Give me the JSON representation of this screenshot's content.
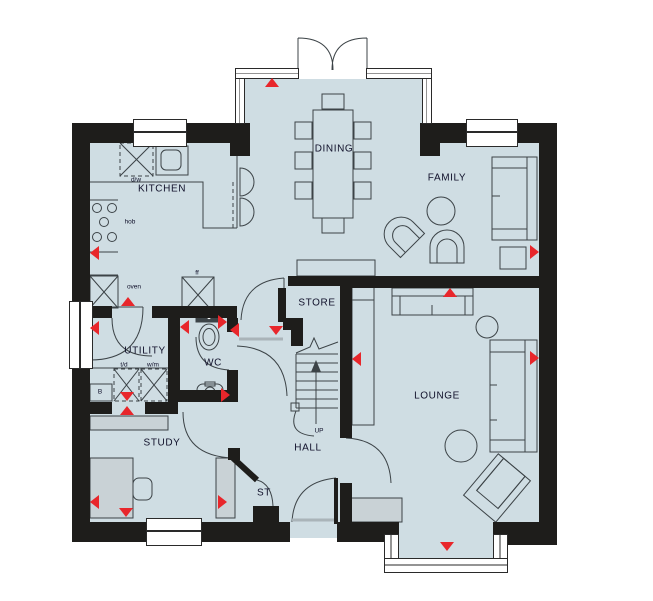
{
  "colors": {
    "floor": "#cfdde3",
    "wall": "#1e1d1b",
    "marker_red": "#e8262b",
    "furniture_outline": "#3c4347",
    "furniture_fill": "#c9d2d6"
  },
  "labels": {
    "kitchen": "KITCHEN",
    "dining": "DINING",
    "family": "FAMILY",
    "store": "STORE",
    "utility": "UTILITY",
    "wc": "WC",
    "lounge": "LOUNGE",
    "study": "STUDY",
    "hall": "HALL",
    "st": "ST",
    "up": "UP",
    "dishwasher": "d/w",
    "hob": "hob",
    "oven": "oven",
    "fridge_freezer": "ff",
    "tumble_dryer": "t/d",
    "washing_machine": "w/m",
    "boiler": "B"
  }
}
